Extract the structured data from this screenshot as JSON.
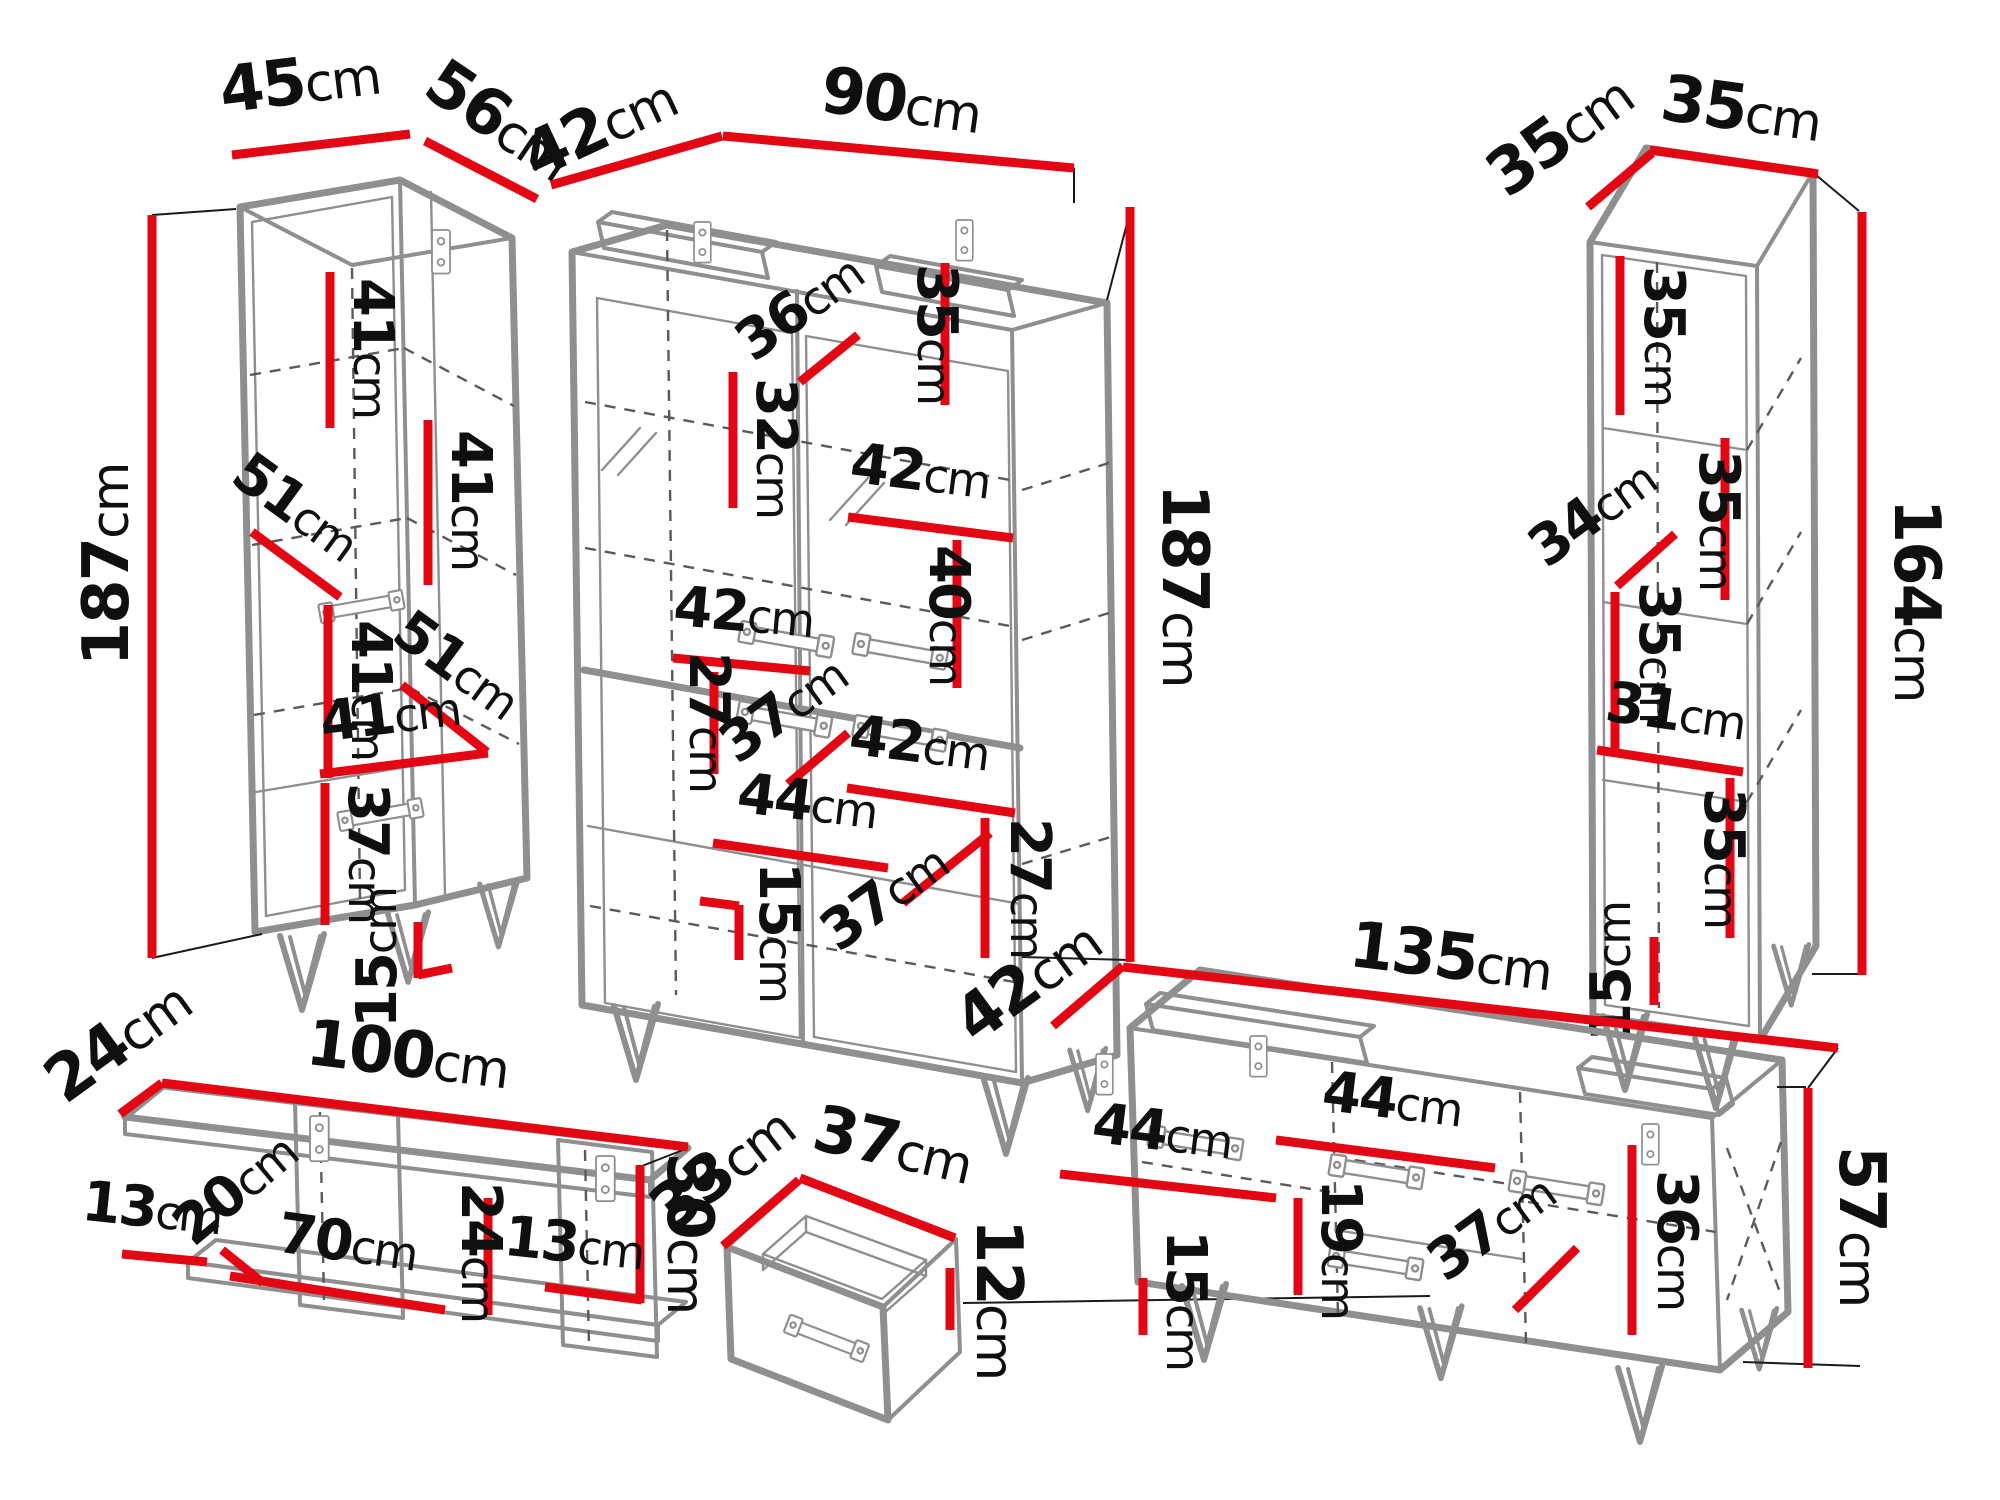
{
  "unit": "cm",
  "colors": {
    "dimension_line": "#e30613",
    "outline": "#8f8f8f",
    "dashed_line": "#5a5a5a",
    "label_text": "#0f0f0f",
    "background": "#ffffff"
  },
  "pieces": [
    {
      "id": "tall-cabinet-left",
      "overall": {
        "width": "45",
        "depth": "56",
        "height": "187"
      },
      "internal": [
        "41",
        "41",
        "51",
        "41",
        "51",
        "41",
        "37",
        "15"
      ]
    },
    {
      "id": "display-cabinet-center",
      "overall": {
        "depth": "42",
        "width": "90",
        "height": "187"
      },
      "internal": [
        "36",
        "35",
        "32",
        "42",
        "40",
        "42",
        "27",
        "37",
        "42",
        "44",
        "37",
        "27",
        "15"
      ]
    },
    {
      "id": "shelf-unit-right",
      "overall": {
        "depth": "35",
        "width": "35",
        "height": "164"
      },
      "internal": [
        "35",
        "34",
        "35",
        "35",
        "31",
        "35",
        "15"
      ]
    },
    {
      "id": "wall-shelf",
      "overall": {
        "depth": "24",
        "width": "100",
        "height": "30"
      },
      "internal": [
        "13",
        "20",
        "70",
        "24",
        "13"
      ]
    },
    {
      "id": "drawer",
      "overall": {
        "depth": "33",
        "width": "37",
        "height": "12"
      },
      "internal": []
    },
    {
      "id": "tv-stand",
      "overall": {
        "depth": "42",
        "width": "135",
        "height": "57"
      },
      "internal": [
        "44",
        "44",
        "19",
        "15",
        "36",
        "37"
      ]
    }
  ]
}
